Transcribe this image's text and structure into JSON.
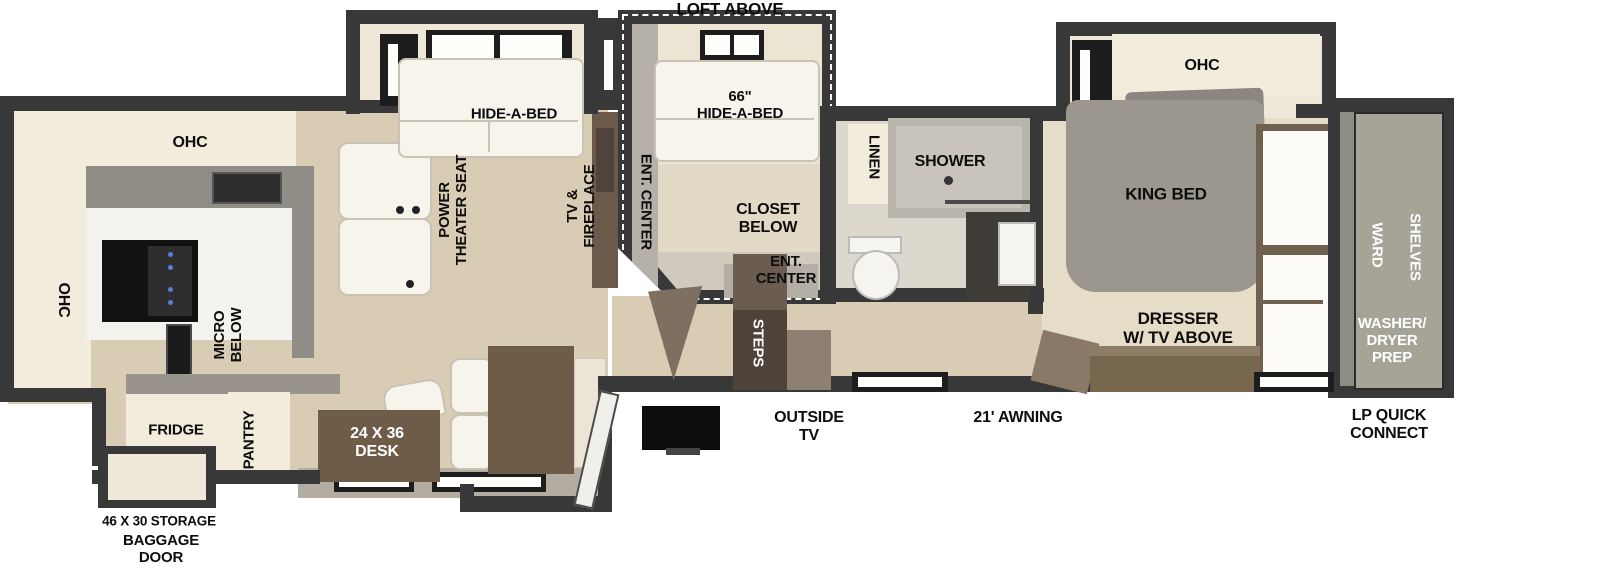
{
  "type": "rv-fifth-wheel-floorplan",
  "colors": {
    "wall": "#383838",
    "floor_wood": "#d9ccb4",
    "floor_bedroom": "#e6ddc8",
    "cabinet_cream": "#f2ecdc",
    "furniture_brown": "#6e5c49",
    "steps_brown": "#4e4338",
    "shower_gray": "#b9b5ad",
    "bed_gray": "#9b978f",
    "closet_gray_green": "#a5a497",
    "label_black": "#0d0d0d",
    "label_white": "#ffffff"
  },
  "rooms": {
    "loft": {
      "title": "LOFT ABOVE",
      "bed": "66\"\nHIDE-A-BED",
      "ent_center_side": "ENT. CENTER",
      "closet": "CLOSET\nBELOW",
      "ent_center": "ENT.\nCENTER"
    },
    "living": {
      "hide_a_bed": "HIDE-A-BED",
      "theater_seat": "POWER\nTHEATER SEAT",
      "tv_fireplace": "TV &\nFIREPLACE"
    },
    "kitchen": {
      "ohc_top": "OHC",
      "ohc_left": "OHC",
      "micro": "MICRO\nBELOW",
      "fridge": "FRIDGE",
      "pantry": "PANTRY"
    },
    "dinette": {
      "desk": "24 X 36\nDESK"
    },
    "entry": {
      "steps": "STEPS"
    },
    "bath": {
      "linen": "LINEN",
      "shower": "SHOWER"
    },
    "bedroom": {
      "ohc": "OHC",
      "king_bed": "KING BED",
      "dresser": "DRESSER\nW/ TV ABOVE"
    },
    "front_closet": {
      "ward": "WARD",
      "shelves": "SHELVES",
      "washer_dryer": "WASHER/\nDRYER\nPREP"
    },
    "exterior": {
      "storage": "46 X 30 STORAGE",
      "baggage_door": "BAGGAGE\nDOOR",
      "outside_tv": "OUTSIDE\nTV",
      "awning": "21' AWNING",
      "lp": "LP QUICK\nCONNECT"
    }
  }
}
